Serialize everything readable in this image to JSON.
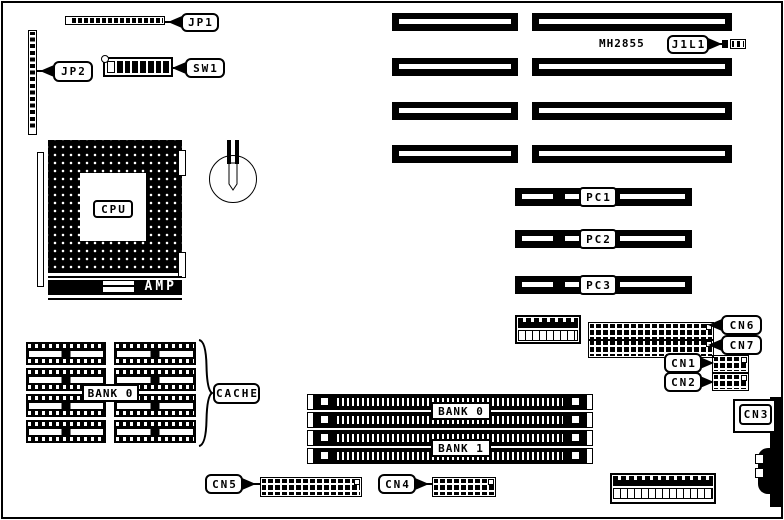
{
  "board": {
    "chip_marking": "MH2855",
    "colors": {
      "ink": "#000000",
      "paper": "#ffffff"
    },
    "jumpers": {
      "jp1": "JP1",
      "jp2": "JP2"
    },
    "switch": {
      "sw1": "SW1"
    },
    "cpu": {
      "label": "CPU",
      "socket_brand": "AMP"
    },
    "connectors": {
      "j1l1": "J1L1",
      "cn1": "CN1",
      "cn2": "CN2",
      "cn3": "CN3",
      "cn4": "CN4",
      "cn5": "CN5",
      "cn6": "CN6",
      "cn7": "CN7"
    },
    "pci_slots": [
      "PC1",
      "PC2",
      "PC3"
    ],
    "cache": {
      "label": "CACHE",
      "bank": "BANK 0"
    },
    "memory": {
      "bank0": "BANK 0",
      "bank1": "BANK 1"
    }
  }
}
